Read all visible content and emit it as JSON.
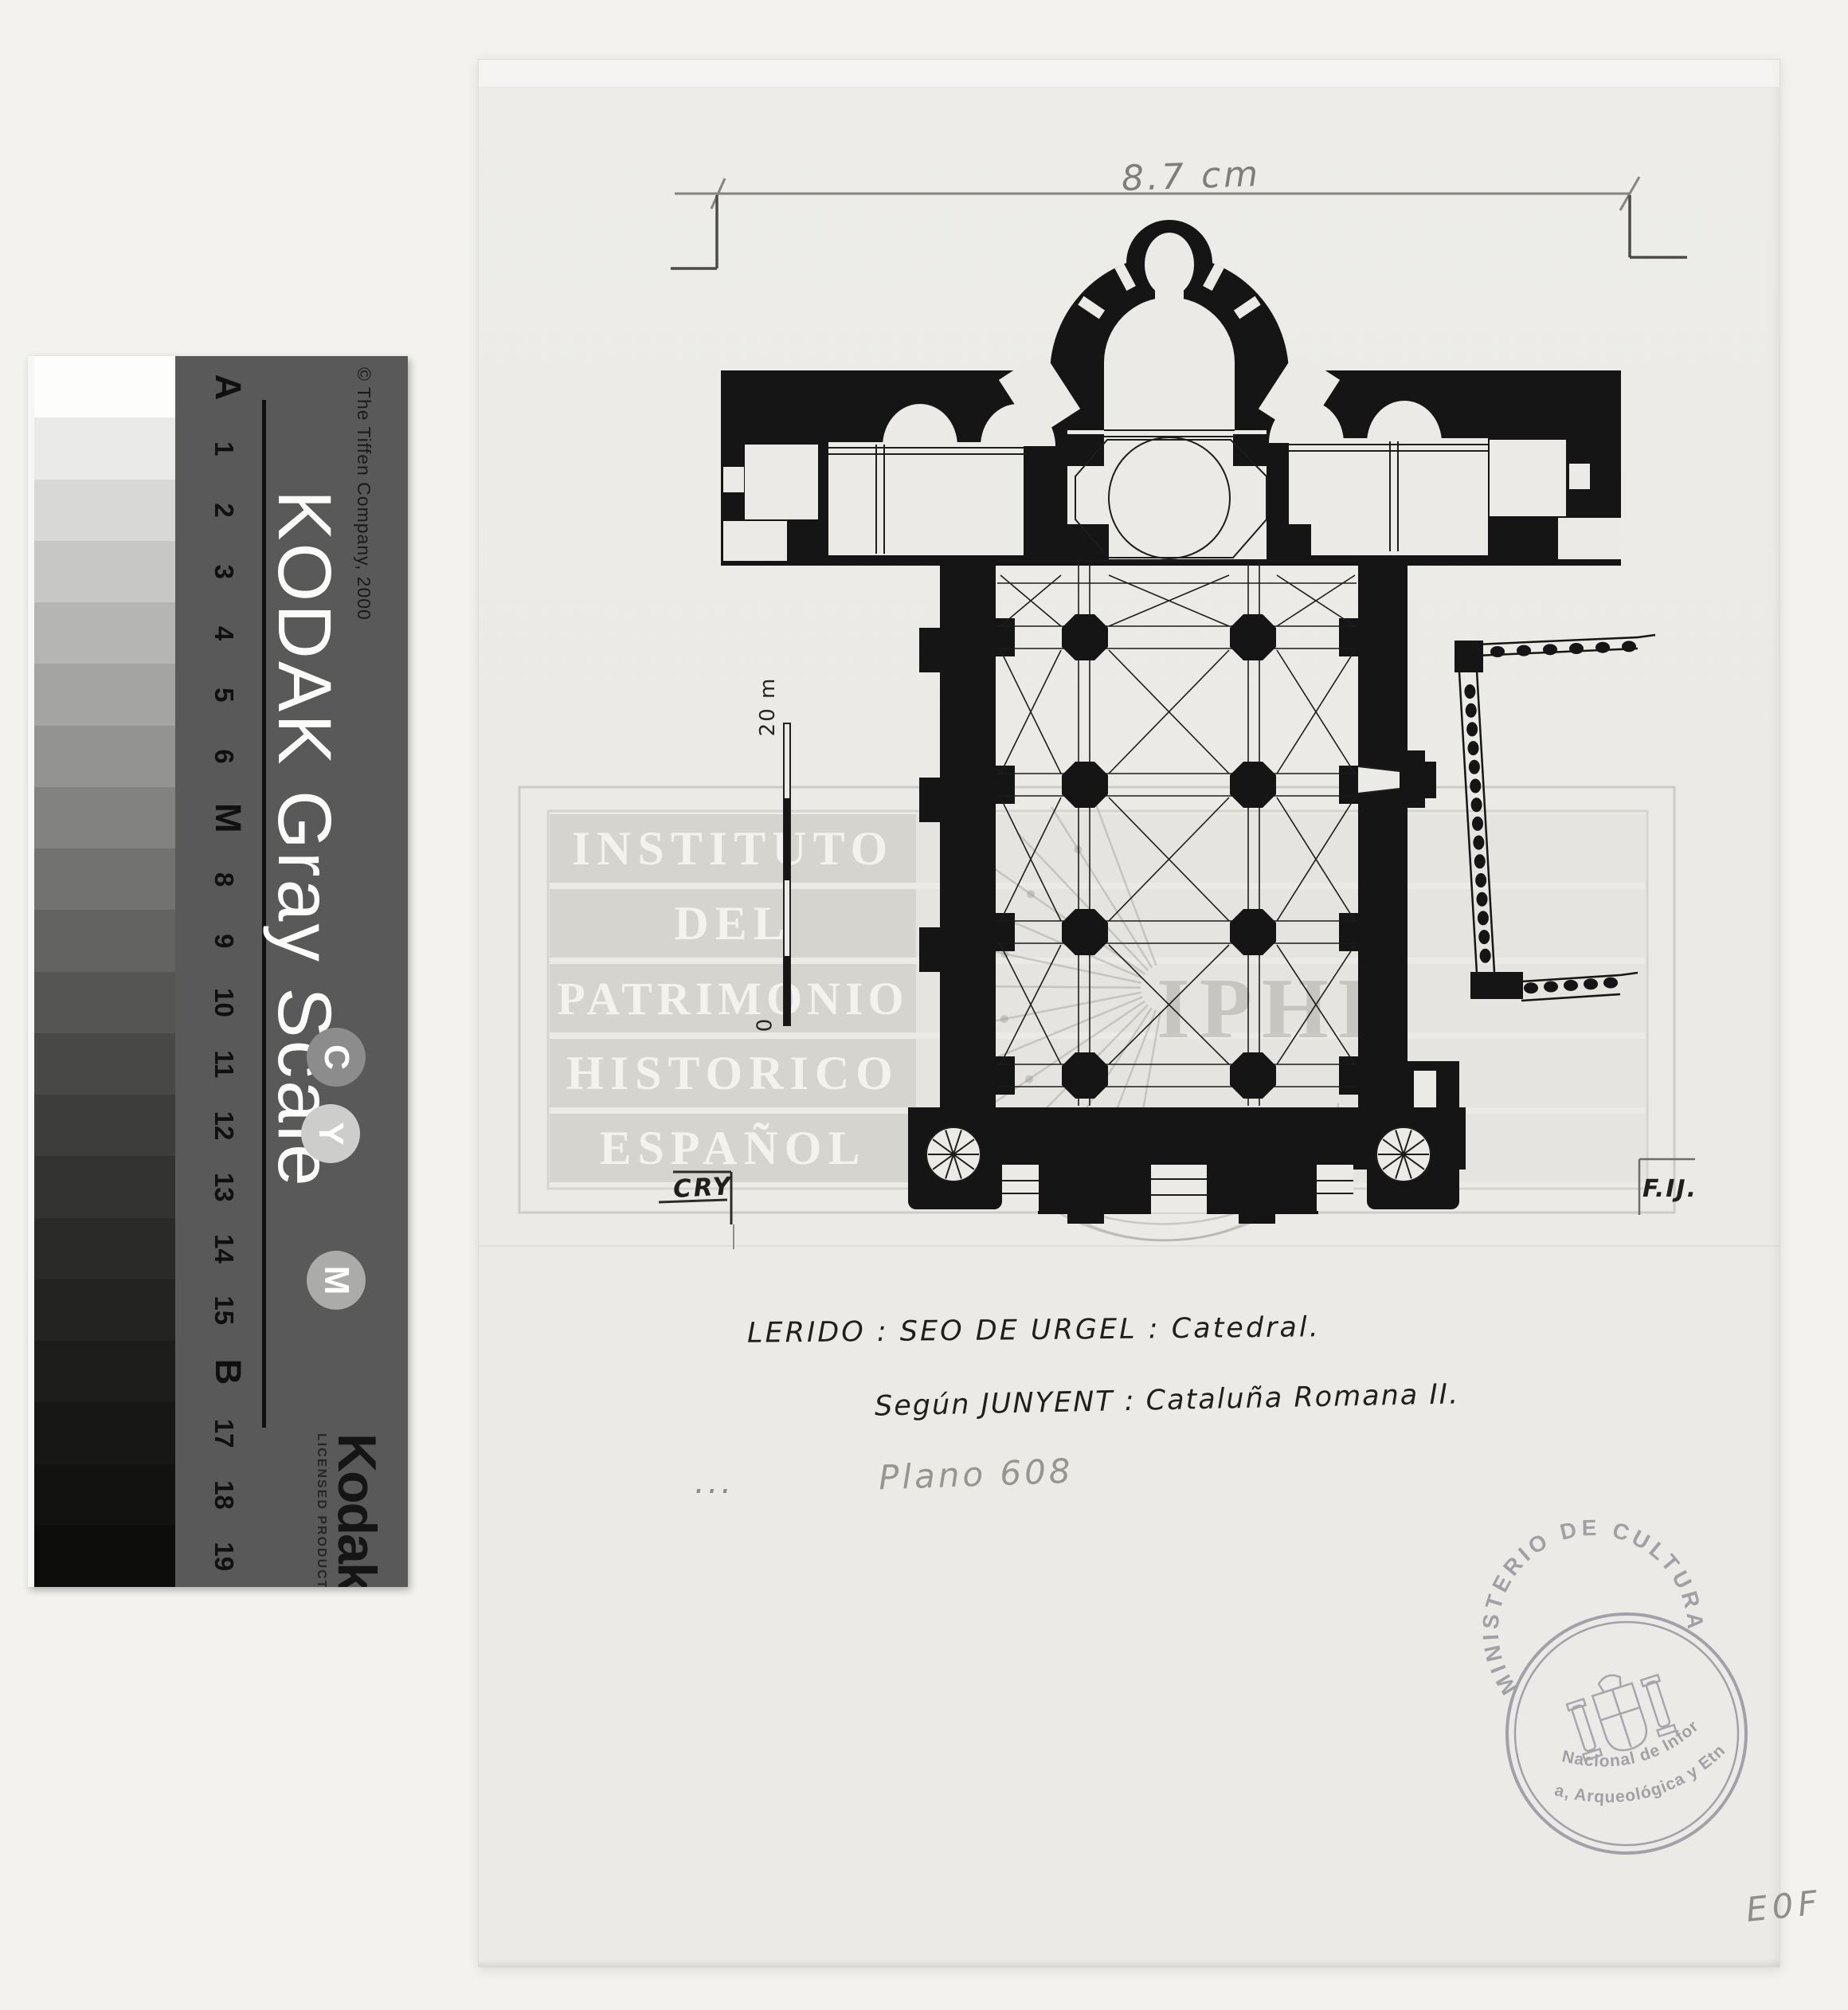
{
  "calibration_strip": {
    "brand_line": "KODAK Gray Scale",
    "copyright": "© The Tiffen Company, 2000",
    "steps": [
      "A",
      "1",
      "2",
      "3",
      "4",
      "5",
      "6",
      "M",
      "8",
      "9",
      "10",
      "11",
      "12",
      "13",
      "14",
      "15",
      "B",
      "17",
      "18",
      "19"
    ],
    "patch_colors": [
      "#fdfdfc",
      "#eaeae8",
      "#d8d8d6",
      "#c7c7c5",
      "#b5b5b3",
      "#a4a4a2",
      "#939391",
      "#828280",
      "#727270",
      "#636361",
      "#555553",
      "#484846",
      "#3d3d3b",
      "#333331",
      "#2a2a28",
      "#232321",
      "#1d1d1b",
      "#171715",
      "#121210",
      "#0d0d0b"
    ],
    "cmy_circles": [
      {
        "label": "C",
        "color": "#8c8c8c"
      },
      {
        "label": "Y",
        "color": "#cdcdcb"
      },
      {
        "label": "M",
        "color": "#ababa9"
      }
    ],
    "logo": "Kodak",
    "logo_sub": "LICENSED PRODUCT",
    "background": "#595959"
  },
  "sheet": {
    "dimension_label": "8.7 cm",
    "scale_bar": {
      "top_label": "20 m",
      "bottom_label": "0"
    },
    "watermark": {
      "lines": [
        "INSTITUTO",
        "DEL",
        "PATRIMONIO",
        "HISTORICO",
        "ESPAÑOL"
      ],
      "monogram": "IPHE"
    },
    "annotations": {
      "reviewer_left": "CRY",
      "reviewer_right": "F.IJ.",
      "title_line1": "LERIDO : SEO DE URGEL : Catedral.",
      "title_line2": "Según JUNYENT : Cataluña Romana II.",
      "plan_number": "Plano 608",
      "dots": "...",
      "corner_code": "E0F"
    },
    "stamp": {
      "ring_text": "MINISTERIO DE CULTURA",
      "center_text_line1": "Centro Nacional de Información",
      "center_text_line2": "- Artística, Arqueológica y Etnológica -",
      "ink": "#8f8f96"
    }
  }
}
